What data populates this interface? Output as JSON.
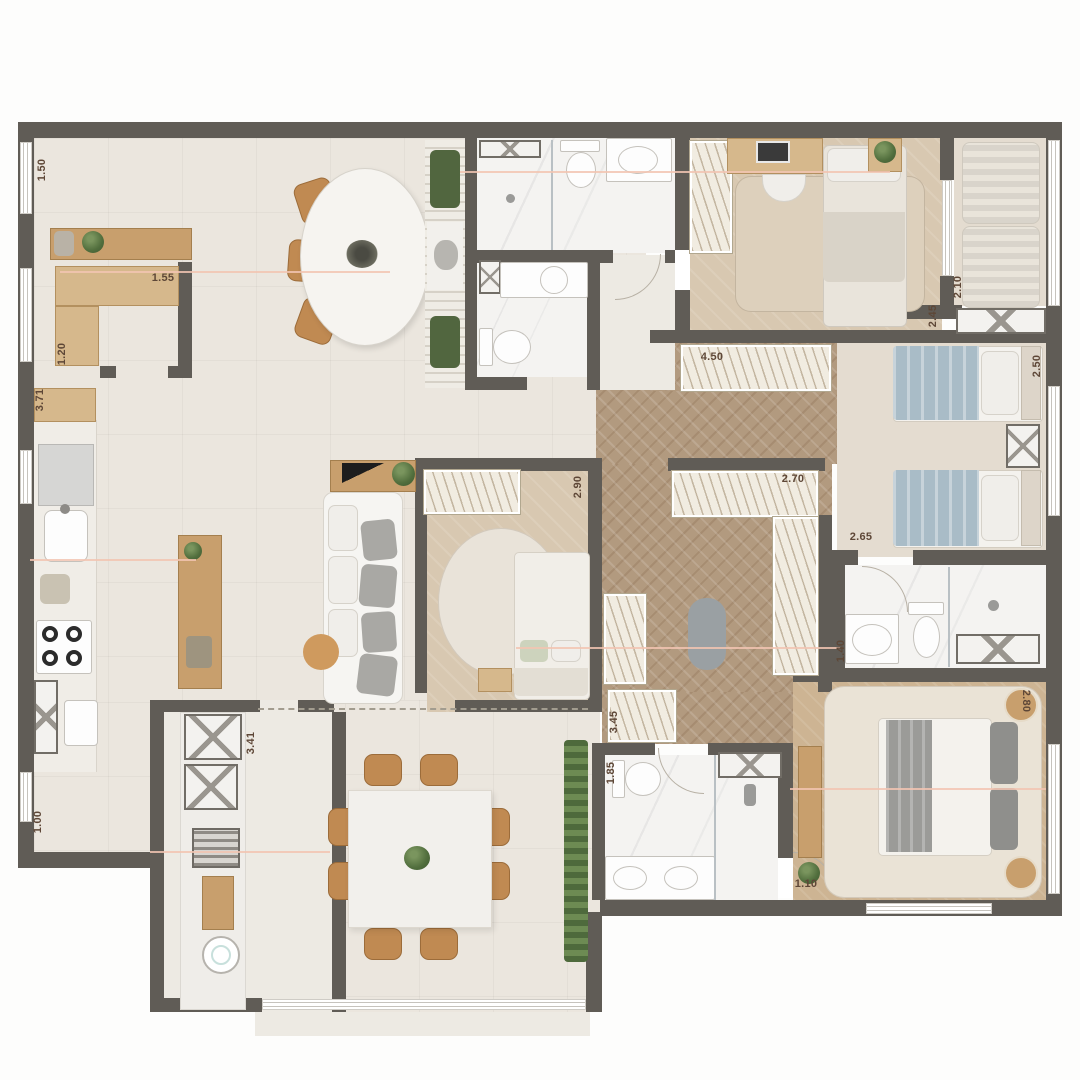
{
  "plan": {
    "type": "residential-apartment-floor-plan",
    "title": "apartment floor plan",
    "dimension_labels": [
      {
        "text": "1.50",
        "x": 42,
        "y": 170,
        "rot": -90
      },
      {
        "text": "1.55",
        "x": 163,
        "y": 278,
        "rot": 0
      },
      {
        "text": "1.20",
        "x": 62,
        "y": 354,
        "rot": -90
      },
      {
        "text": "3.71",
        "x": 40,
        "y": 400,
        "rot": -90
      },
      {
        "text": "2.45",
        "x": 933,
        "y": 316,
        "rot": -90
      },
      {
        "text": "2.10",
        "x": 958,
        "y": 287,
        "rot": -90
      },
      {
        "text": "2.50",
        "x": 1037,
        "y": 366,
        "rot": -90
      },
      {
        "text": "4.50",
        "x": 712,
        "y": 357,
        "rot": 0
      },
      {
        "text": "2.90",
        "x": 578,
        "y": 487,
        "rot": -90
      },
      {
        "text": "2.70",
        "x": 793,
        "y": 479,
        "rot": 0
      },
      {
        "text": "2.65",
        "x": 861,
        "y": 537,
        "rot": 0
      },
      {
        "text": "1.40",
        "x": 841,
        "y": 651,
        "rot": -90
      },
      {
        "text": "3.45",
        "x": 614,
        "y": 722,
        "rot": -90
      },
      {
        "text": "1.85",
        "x": 611,
        "y": 773,
        "rot": -90
      },
      {
        "text": "1.10",
        "x": 806,
        "y": 884,
        "rot": 0
      },
      {
        "text": "2.80",
        "x": 1026,
        "y": 701,
        "rot": 90
      },
      {
        "text": "3.41",
        "x": 251,
        "y": 743,
        "rot": -90
      },
      {
        "text": "1.00",
        "x": 38,
        "y": 822,
        "rot": -90
      }
    ],
    "palette": {
      "wall": "#605c56",
      "social_floor": "#ebe6de",
      "herringbone_wood": "#b29a7f",
      "bedroom_floor": "#d8c8b1",
      "marble": "#f4f3f1",
      "furniture_wood": "#c89f6d",
      "chair_tan": "#c08a52",
      "bedding_blue": "#a9bcc7",
      "plant_green": "#516e3d",
      "dimension_text": "#5e4737",
      "dimension_line": "#f2c4b2"
    }
  }
}
